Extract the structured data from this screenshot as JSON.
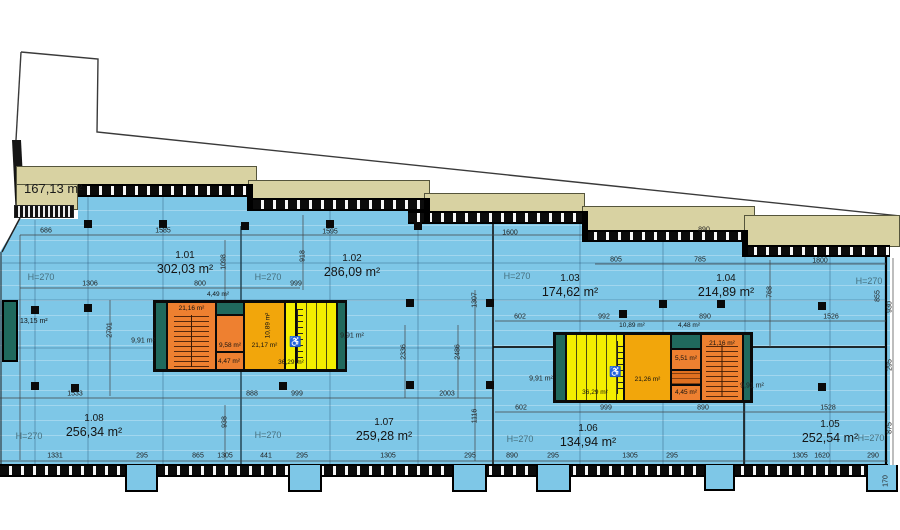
{
  "plan": {
    "terrace_area": "167,13 m²",
    "shaft_room_area": "13,15 m²",
    "units": [
      {
        "name": "1.01",
        "area": "302,03 m²",
        "x": 185,
        "y": 250
      },
      {
        "name": "1.02",
        "area": "286,09 m²",
        "x": 352,
        "y": 253
      },
      {
        "name": "1.03",
        "area": "174,62 m²",
        "x": 570,
        "y": 273
      },
      {
        "name": "1.04",
        "area": "214,89 m²",
        "x": 726,
        "y": 273
      },
      {
        "name": "1.05",
        "area": "252,54 m²",
        "x": 830,
        "y": 419
      },
      {
        "name": "1.06",
        "area": "134,94 m²",
        "x": 588,
        "y": 423
      },
      {
        "name": "1.07",
        "area": "259,28 m²",
        "x": 384,
        "y": 417
      },
      {
        "name": "1.08",
        "area": "256,34 m²",
        "x": 94,
        "y": 413
      }
    ],
    "height_labels": [
      {
        "t": "H=270",
        "x": 41,
        "y": 272
      },
      {
        "t": "H=270",
        "x": 268,
        "y": 272
      },
      {
        "t": "H=270",
        "x": 517,
        "y": 271
      },
      {
        "t": "H=270",
        "x": 869,
        "y": 276
      },
      {
        "t": "H=270",
        "x": 29,
        "y": 431
      },
      {
        "t": "H=270",
        "x": 268,
        "y": 430
      },
      {
        "t": "H=270",
        "x": 520,
        "y": 434
      },
      {
        "t": "H=270",
        "x": 871,
        "y": 433
      }
    ]
  },
  "left_core": {
    "stair": "21,16 m²",
    "lift": "9,58 m²",
    "small": "4,47 m²",
    "corridor": "21,17 m²",
    "wc": "36,29 m²",
    "lobby": "10,89 m²",
    "above": "4,49 m²"
  },
  "right_core": {
    "stair": "21,16 m²",
    "corridor": "21,26 m²",
    "wc": "36,29 m²",
    "room_a": "5,51 m²",
    "room_b": "4,45 m²",
    "above_left": "10,89 m²",
    "above_right": "4,48 m²"
  },
  "dimensions": [
    {
      "t": "686",
      "x": 46,
      "y": 231
    },
    {
      "t": "1585",
      "x": 163,
      "y": 231
    },
    {
      "t": "1595",
      "x": 330,
      "y": 232
    },
    {
      "t": "1600",
      "x": 510,
      "y": 233
    },
    {
      "t": "890",
      "x": 704,
      "y": 230
    },
    {
      "t": "805",
      "x": 616,
      "y": 260
    },
    {
      "t": "785",
      "x": 700,
      "y": 260
    },
    {
      "t": "1800",
      "x": 820,
      "y": 261
    },
    {
      "t": "1306",
      "x": 90,
      "y": 284
    },
    {
      "t": "800",
      "x": 200,
      "y": 284
    },
    {
      "t": "999",
      "x": 296,
      "y": 284
    },
    {
      "t": "918",
      "x": 303,
      "y": 256,
      "r": 1
    },
    {
      "t": "1098",
      "x": 224,
      "y": 262,
      "r": 1
    },
    {
      "t": "2701",
      "x": 110,
      "y": 330,
      "r": 1
    },
    {
      "t": "1307",
      "x": 475,
      "y": 300,
      "r": 1
    },
    {
      "t": "2336",
      "x": 404,
      "y": 352,
      "r": 1
    },
    {
      "t": "2486",
      "x": 458,
      "y": 352,
      "r": 1
    },
    {
      "t": "768",
      "x": 770,
      "y": 292,
      "r": 1
    },
    {
      "t": "855",
      "x": 878,
      "y": 296,
      "r": 1
    },
    {
      "t": "930",
      "x": 890,
      "y": 307,
      "r": 1
    },
    {
      "t": "602",
      "x": 520,
      "y": 317
    },
    {
      "t": "992",
      "x": 604,
      "y": 317
    },
    {
      "t": "890",
      "x": 705,
      "y": 317
    },
    {
      "t": "1526",
      "x": 831,
      "y": 317
    },
    {
      "t": "1533",
      "x": 75,
      "y": 394
    },
    {
      "t": "888",
      "x": 252,
      "y": 394
    },
    {
      "t": "999",
      "x": 297,
      "y": 394
    },
    {
      "t": "2003",
      "x": 447,
      "y": 394
    },
    {
      "t": "1116",
      "x": 475,
      "y": 416,
      "r": 1
    },
    {
      "t": "602",
      "x": 521,
      "y": 408
    },
    {
      "t": "999",
      "x": 606,
      "y": 408
    },
    {
      "t": "890",
      "x": 703,
      "y": 408
    },
    {
      "t": "1528",
      "x": 828,
      "y": 408
    },
    {
      "t": "295",
      "x": 890,
      "y": 365,
      "r": 1
    },
    {
      "t": "875",
      "x": 890,
      "y": 428,
      "r": 1
    },
    {
      "t": "938",
      "x": 225,
      "y": 422,
      "r": 1
    },
    {
      "t": "170",
      "x": 886,
      "y": 481,
      "r": 1
    },
    {
      "t": "1331",
      "x": 55,
      "y": 456
    },
    {
      "t": "295",
      "x": 142,
      "y": 456
    },
    {
      "t": "865",
      "x": 198,
      "y": 456
    },
    {
      "t": "1305",
      "x": 225,
      "y": 456
    },
    {
      "t": "441",
      "x": 266,
      "y": 456
    },
    {
      "t": "295",
      "x": 302,
      "y": 456
    },
    {
      "t": "1305",
      "x": 388,
      "y": 456
    },
    {
      "t": "295",
      "x": 470,
      "y": 456
    },
    {
      "t": "890",
      "x": 512,
      "y": 456
    },
    {
      "t": "295",
      "x": 553,
      "y": 456
    },
    {
      "t": "1305",
      "x": 630,
      "y": 456
    },
    {
      "t": "295",
      "x": 672,
      "y": 456
    },
    {
      "t": "1305",
      "x": 800,
      "y": 456
    },
    {
      "t": "1620",
      "x": 822,
      "y": 456
    },
    {
      "t": "290",
      "x": 873,
      "y": 456
    },
    {
      "t": "9,91 m²",
      "x": 143,
      "y": 341,
      "c": "sm"
    },
    {
      "t": "9,91 m²",
      "x": 352,
      "y": 336,
      "c": "sm"
    },
    {
      "t": "9,91 m²",
      "x": 541,
      "y": 379,
      "c": "sm"
    },
    {
      "t": "9,91 m²",
      "x": 752,
      "y": 386,
      "c": "sm"
    }
  ],
  "columns": [
    {
      "x": 84,
      "y": 220
    },
    {
      "x": 159,
      "y": 220
    },
    {
      "x": 241,
      "y": 222
    },
    {
      "x": 326,
      "y": 220
    },
    {
      "x": 414,
      "y": 222
    },
    {
      "x": 31,
      "y": 306
    },
    {
      "x": 84,
      "y": 304
    },
    {
      "x": 406,
      "y": 299
    },
    {
      "x": 486,
      "y": 299
    },
    {
      "x": 619,
      "y": 310
    },
    {
      "x": 659,
      "y": 300
    },
    {
      "x": 717,
      "y": 300
    },
    {
      "x": 818,
      "y": 302
    },
    {
      "x": 31,
      "y": 382
    },
    {
      "x": 71,
      "y": 384
    },
    {
      "x": 279,
      "y": 382
    },
    {
      "x": 406,
      "y": 381
    },
    {
      "x": 486,
      "y": 381
    },
    {
      "x": 818,
      "y": 383
    }
  ]
}
